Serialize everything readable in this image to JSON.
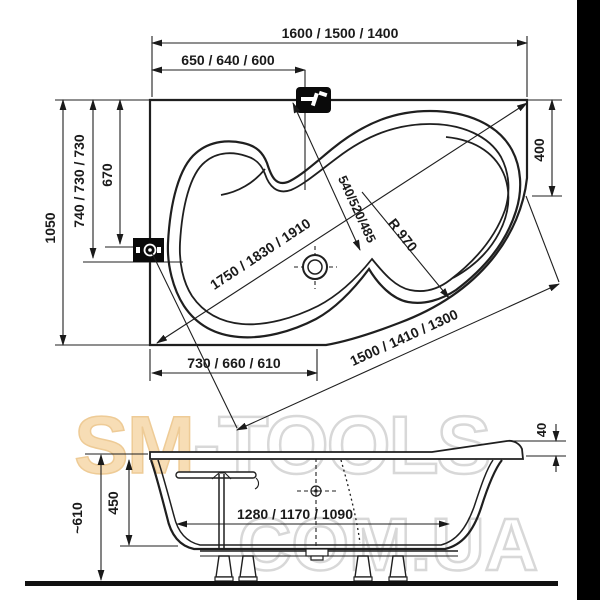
{
  "palette": {
    "line_color": "#1f1f1f",
    "border_strip": "#000000",
    "watermark_fill": "#f7ddb5",
    "watermark_stroke": "#eecb96",
    "watermark_outline": "#d8d8d8"
  },
  "watermark": {
    "sm": "SM",
    "tools": "-TOOLS",
    "domain": "COM.UA"
  },
  "plan_view": {
    "dims": {
      "overall_width": "1600 / 1500 / 1400",
      "faucet_offset": "650 / 640 / 600",
      "overall_depth": "1050",
      "left_depth": "740 / 730 / 730",
      "drain_depth": "670",
      "right_edge": "400",
      "diagonal_length": "1750 / 1830 / 1910",
      "inner_width": "540/520/485",
      "radius": "R 970",
      "bottom_left_width": "730 / 660 / 610",
      "front_edge_length": "1500 / 1410 / 1300"
    }
  },
  "side_view": {
    "dims": {
      "rim_height": "40",
      "inner_depth": "450",
      "total_height": "~610",
      "bottom_length": "1280 / 1170 / 1090"
    }
  }
}
